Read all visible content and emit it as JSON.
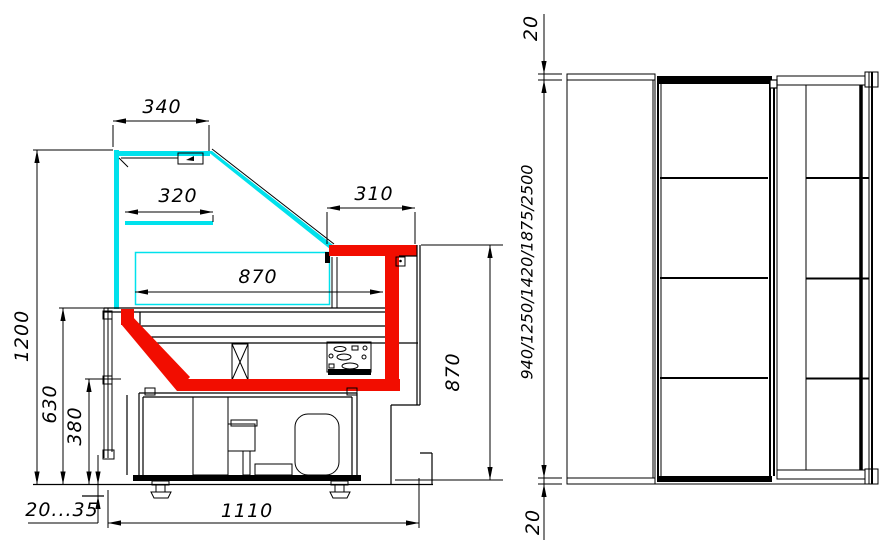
{
  "colors": {
    "glass_cyan": "#00e1ec",
    "profile_red": "#f20d00",
    "line_black": "#000000"
  },
  "side_view": {
    "title": "side-section-view",
    "dims": {
      "canopy_top": "340",
      "inner_shelf": "320",
      "rear_shelf": "310",
      "deck_width": "870",
      "overall_height": "1200",
      "deck_height": "630",
      "basin_height": "380",
      "foot_adjust": "20...35",
      "base_depth": "1110",
      "rear_height": "870"
    }
  },
  "front_view": {
    "title": "front-view",
    "dims": {
      "top_overhang": "20",
      "length_options": "940/1250/1420/1875/2500",
      "bottom_overhang": "20"
    }
  }
}
